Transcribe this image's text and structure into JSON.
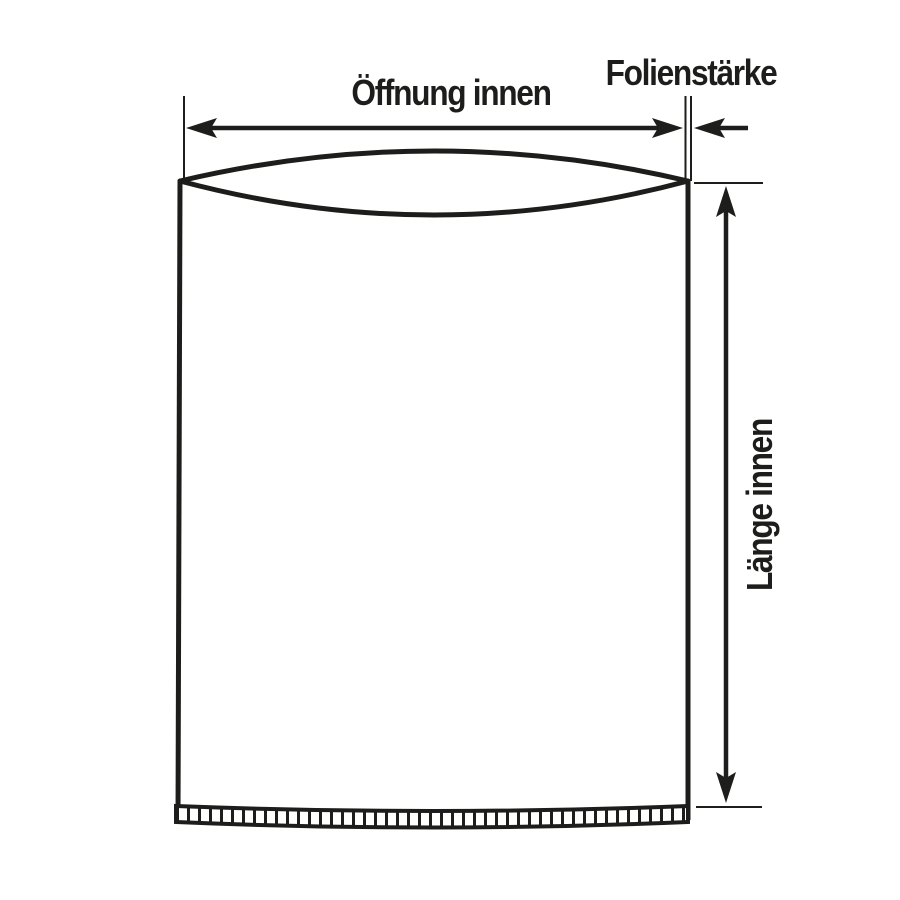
{
  "diagram": {
    "kind": "technical-dimension-diagram",
    "labels": {
      "opening_width": "Öffnung innen",
      "film_thickness": "Folienstärke",
      "inner_length": "Länge innen"
    },
    "colors": {
      "ink": "#1d1d1b",
      "background": "#ffffff"
    }
  }
}
